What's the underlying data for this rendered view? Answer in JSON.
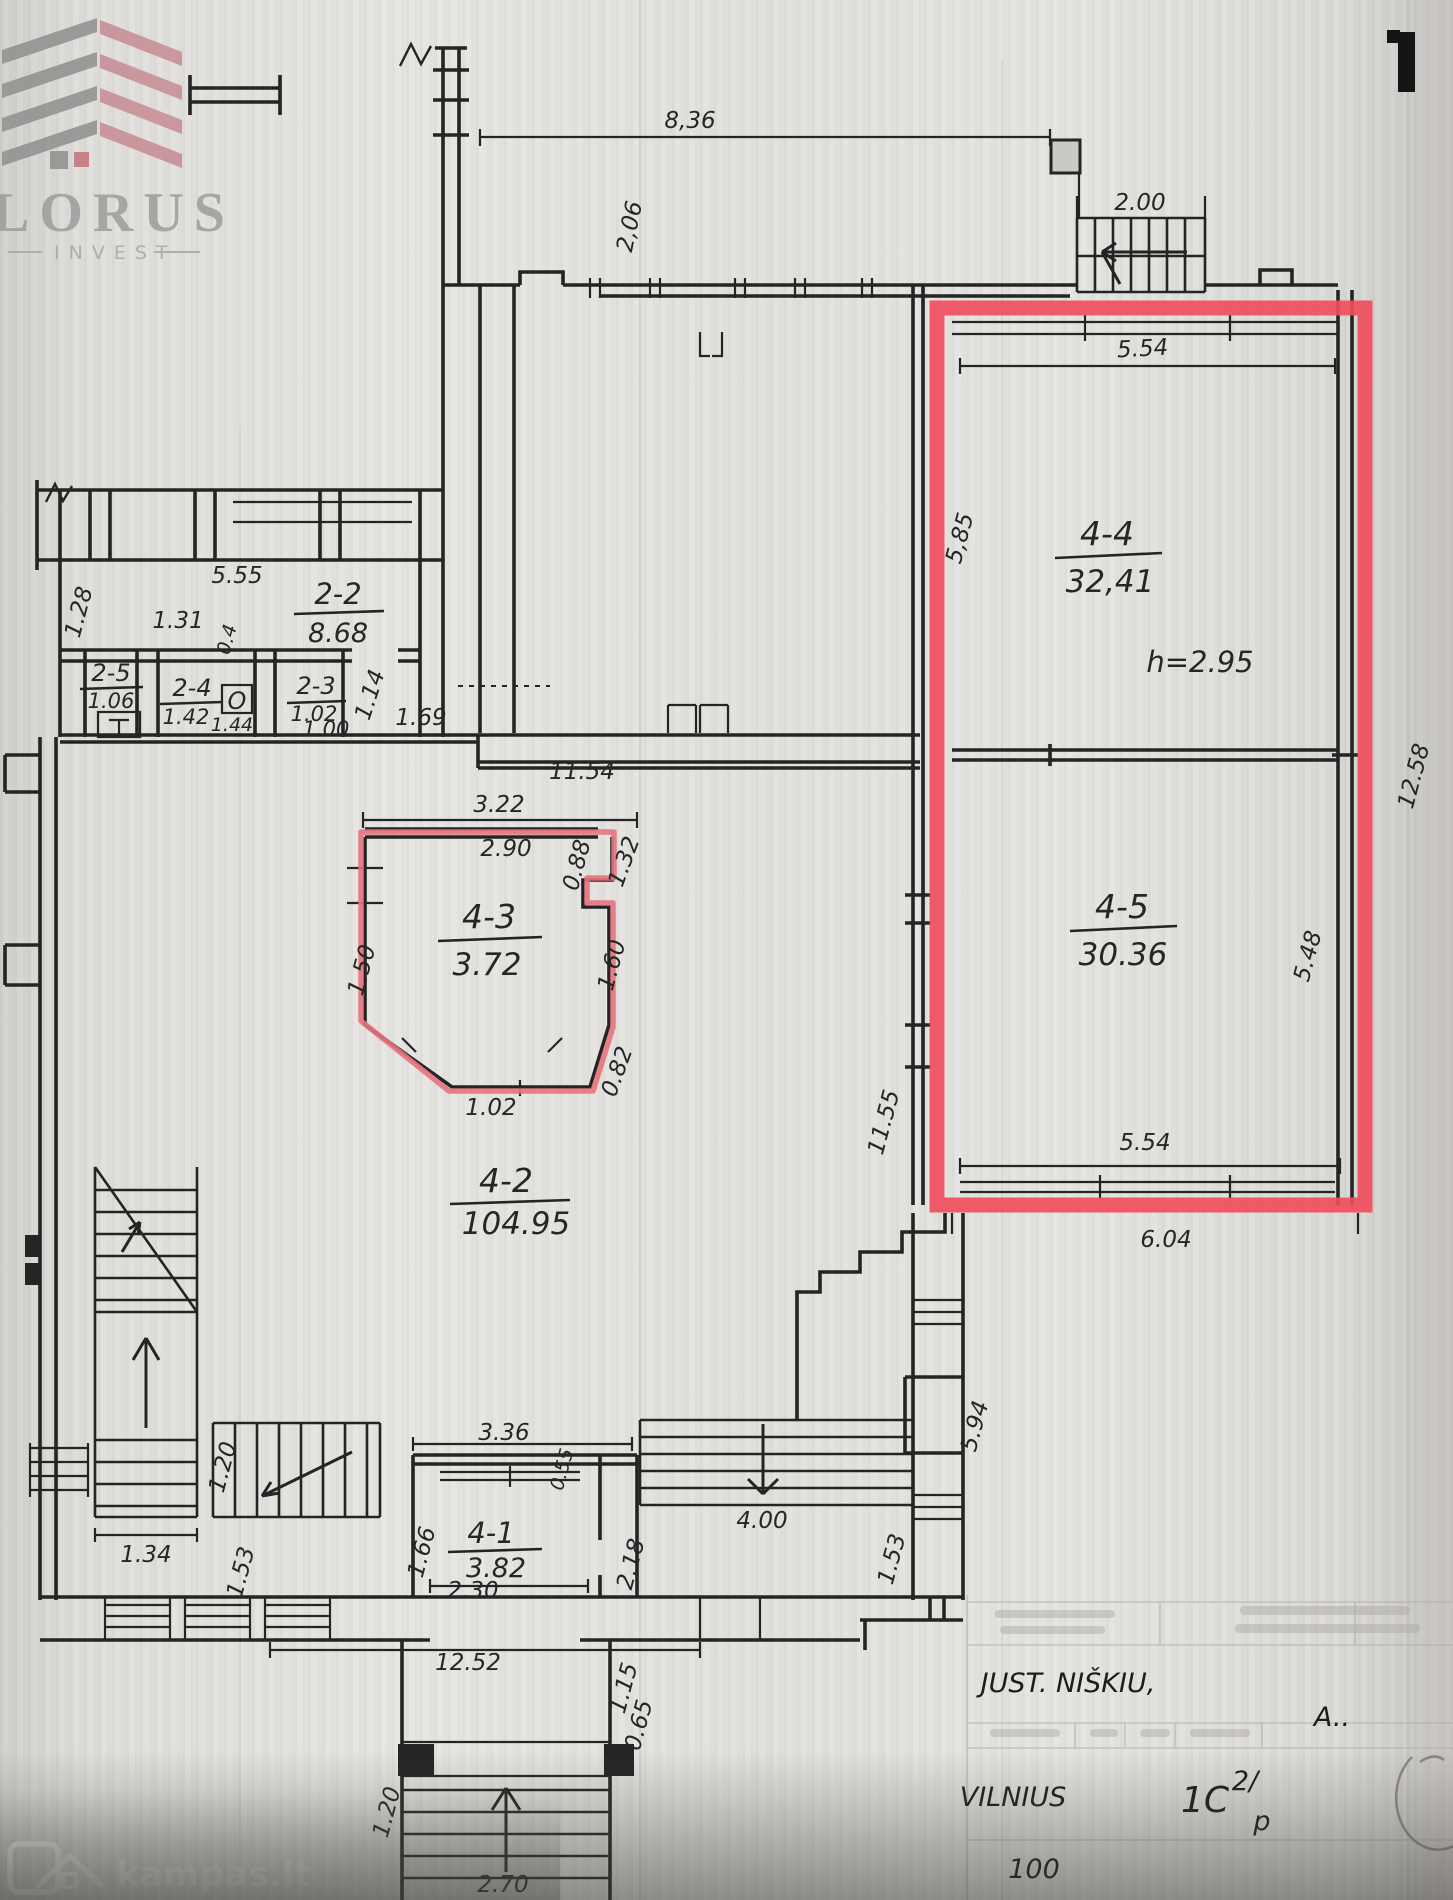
{
  "logo": {
    "name": "LORUS",
    "subtitle": "INVEST"
  },
  "watermark": {
    "site": "kampas.lt"
  },
  "title_block": {
    "street": "JUST. NIŠKIU,",
    "city": "VILNIUS",
    "sheet_code": "1C",
    "sheet_sup": "2/",
    "sheet_sub": "p",
    "scale": "100",
    "initials": "A.."
  },
  "annotations": {
    "ceiling_height": "h=2.95",
    "fixture": "O"
  },
  "rooms": {
    "r22": {
      "id": "2-2",
      "area": "8.68"
    },
    "r25": {
      "id": "2-5",
      "area": "1.06"
    },
    "r24": {
      "id": "2-4",
      "area": "1.42"
    },
    "r23": {
      "id": "2-3",
      "area": "1.02",
      "area2": "1.00"
    },
    "r41": {
      "id": "4-1",
      "area": "3.82"
    },
    "r42": {
      "id": "4-2",
      "area": "104.95"
    },
    "r43": {
      "id": "4-3",
      "area": "3.72"
    },
    "r44": {
      "id": "4-4",
      "area": "32,41"
    },
    "r45": {
      "id": "4-5",
      "area": "30.36"
    }
  },
  "dims": {
    "top_span": "8,36",
    "wing_height": "2,06",
    "stair_width": "2.00",
    "r44_width": "5.54",
    "r44_height": "5,85",
    "right_height": "12.58",
    "r45_height": "5.48",
    "left_height": "11.55",
    "r45_width": "5.54",
    "red_bottom_width": "6.04",
    "wing_top": "5.55",
    "w_128": "1.28",
    "w_131": "1.31",
    "w_04": "0.4",
    "w_144": "1.44",
    "w_114": "1.14",
    "w_169": "1.69",
    "corridor_width": "11.54",
    "bay_outer": "3.22",
    "bay_inner": "2.90",
    "bay_088": "0.88",
    "bay_132": "1.32",
    "bay_150": "1.50",
    "bay_160": "1.60",
    "bay_082": "0.82",
    "bay_102": "1.02",
    "st_134": "1.34",
    "st_153_left": "1.53",
    "st_120": "1.20",
    "mid_336": "3.36",
    "mid_055": "0.55",
    "mid_166": "1.66",
    "mid_230": "2.30",
    "mid_218": "2.18",
    "st_400": "4.00",
    "st_153_right": "1.53",
    "right_594": "5.94",
    "bottom_span": "12.52",
    "b_115": "1.15",
    "b_065": "0.65",
    "b_120": "1.20",
    "b_270": "2.70"
  },
  "colors": {
    "highlight": "#ef4e5c",
    "bay_highlight": "#e7737d",
    "ink": "#242424",
    "logo_gray": "#9c9c9c",
    "logo_red": "#c58b92",
    "paper": "#e2e0dc"
  }
}
